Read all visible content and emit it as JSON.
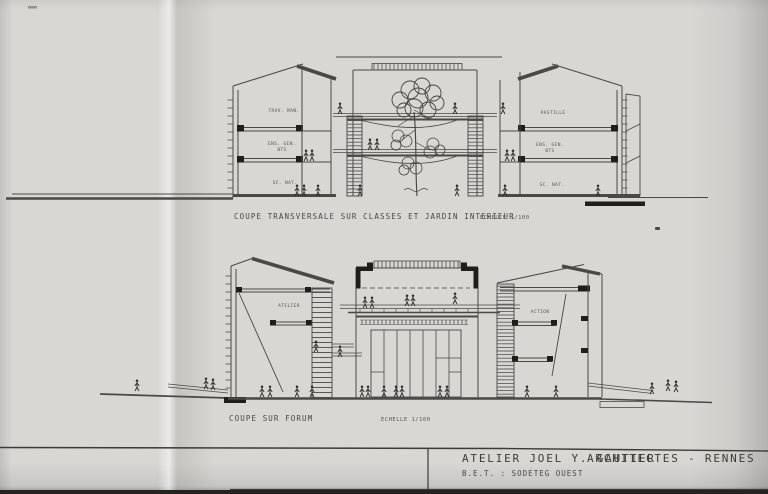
{
  "colors": {
    "paper": "#d8d7d4",
    "ink": "#4b4946",
    "ink_dark": "#201e1b",
    "photo_background": "#26231f"
  },
  "upper_section": {
    "caption": "COUPE TRANSVERSALE SUR CLASSES ET JARDIN INTERIEUR",
    "scale_note": "ECHELLE 1/100",
    "left_block": {
      "floor3": "TRAV. MAN.",
      "floor2_line1": "ENS. GEN.",
      "floor2_line2": "BTS",
      "floor1": "SC. NAT."
    },
    "right_block": {
      "floor3": "PASTILLE",
      "floor2_line1": "ENS. GEN.",
      "floor2_line2": "BTS",
      "floor1": "SC. NAT."
    }
  },
  "lower_section": {
    "caption": "COUPE SUR FORUM",
    "scale_note": "ECHELLE 1/100",
    "left_label": "ATELIER",
    "right_label": "ACTION"
  },
  "title_block": {
    "studio": "ATELIER JOEL Y. GAUTIER",
    "profession_city": "ARCHITECTES - RENNES",
    "engineer": "B.E.T. : SODETEG OUEST"
  }
}
